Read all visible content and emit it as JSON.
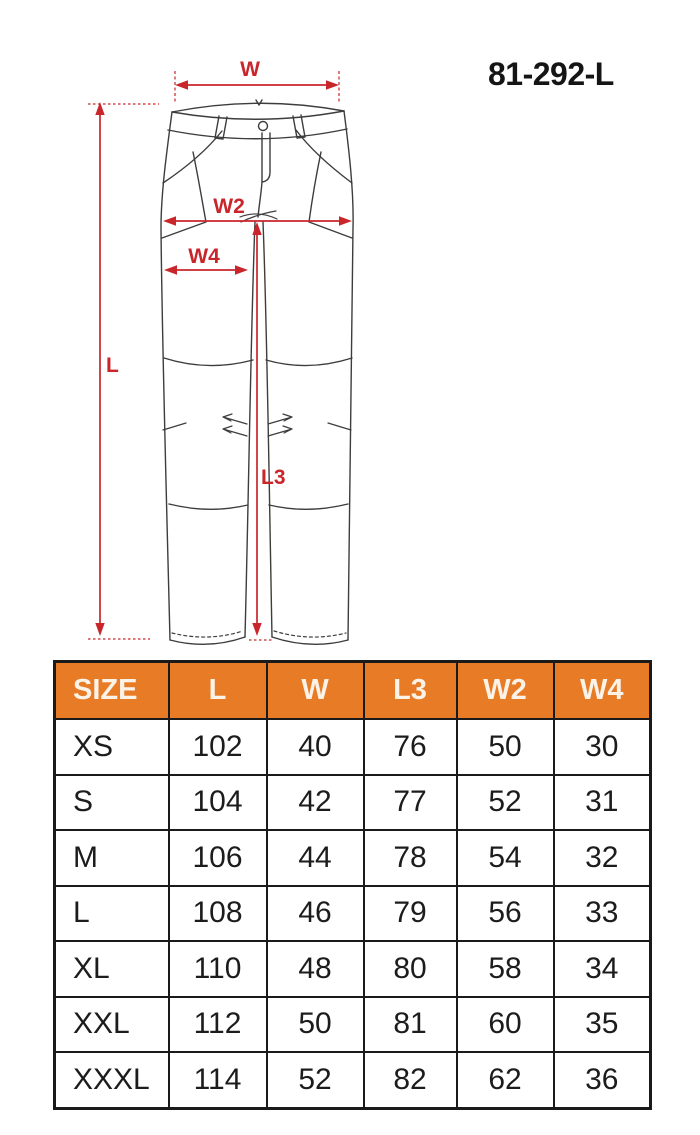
{
  "product_code": "81-292-L",
  "colors": {
    "header_orange": "#e87c26",
    "dimension_red": "#c8262b",
    "outline_gray": "#3d3d3d",
    "table_border": "#1a1a1a"
  },
  "diagram": {
    "type": "trousers-front-technical-drawing",
    "labels": {
      "w": "W",
      "w2": "W2",
      "w4": "W4",
      "l": "L",
      "l3": "L3"
    }
  },
  "table": {
    "columns": [
      "SIZE",
      "L",
      "W",
      "L3",
      "W2",
      "W4"
    ],
    "rows": [
      [
        "XS",
        "102",
        "40",
        "76",
        "50",
        "30"
      ],
      [
        "S",
        "104",
        "42",
        "77",
        "52",
        "31"
      ],
      [
        "M",
        "106",
        "44",
        "78",
        "54",
        "32"
      ],
      [
        "L",
        "108",
        "46",
        "79",
        "56",
        "33"
      ],
      [
        "XL",
        "110",
        "48",
        "80",
        "58",
        "34"
      ],
      [
        "XXL",
        "112",
        "50",
        "81",
        "60",
        "35"
      ],
      [
        "XXXL",
        "114",
        "52",
        "82",
        "62",
        "36"
      ]
    ]
  }
}
